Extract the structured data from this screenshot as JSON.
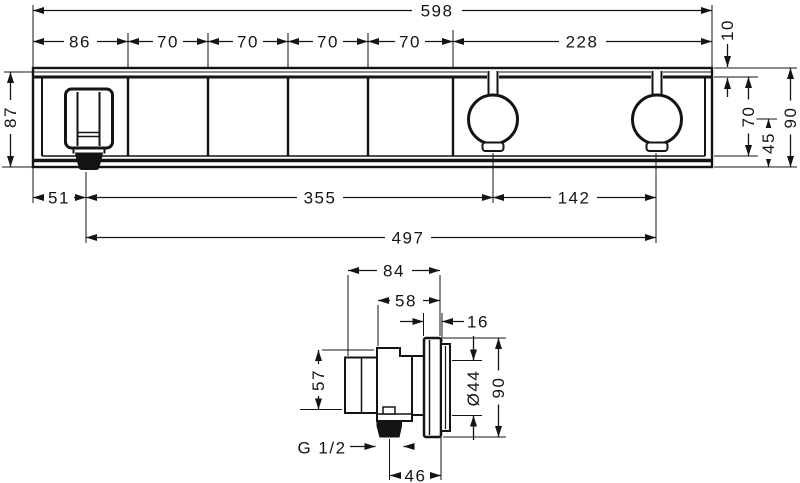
{
  "colors": {
    "line": "#141414",
    "background": "#ffffff"
  },
  "front_view": {
    "dim_overall_width": "598",
    "dim_segments": [
      "86",
      "70",
      "70",
      "70",
      "70",
      "228"
    ],
    "dim_height_total_left": "87",
    "dim_trim_thickness": "10",
    "dim_plate_height": "70",
    "dim_handle_to_bottom": "45",
    "dim_height_total_right": "90",
    "dim_spout_offset": "51",
    "dim_spout_to_handle": "355",
    "dim_handle_spacing": "142",
    "dim_spout_to_last_handle": "497"
  },
  "side_view": {
    "dim_depth_total": "84",
    "dim_depth_body": "58",
    "dim_flange_depth": "16",
    "dim_body_height": "57",
    "dim_cutout_diameter": "Ø44",
    "dim_flange_height": "90",
    "thread_label": "G 1/2",
    "dim_outlet_offset": "46"
  }
}
